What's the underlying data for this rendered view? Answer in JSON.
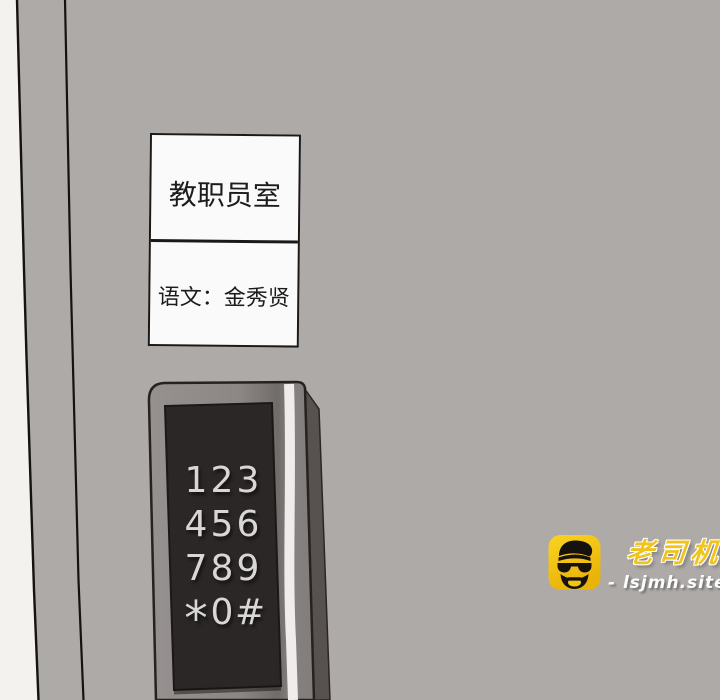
{
  "sign": {
    "room_label": "教职员室",
    "teacher_label": "语文：金秀贤"
  },
  "keypad": {
    "rows": [
      [
        "1",
        "2",
        "3"
      ],
      [
        "4",
        "5",
        "6"
      ],
      [
        "7",
        "8",
        "9"
      ],
      [
        "*",
        "0",
        "#"
      ]
    ]
  },
  "watermark": {
    "brand": "老司机",
    "site": "- lsjmh.site -"
  },
  "colors": {
    "door": "#aeaaa8",
    "wall_strip": "#f4f2ef",
    "line_ink": "#131313",
    "sign_background": "#fbfafa",
    "keypad_bezel": "#8b8683",
    "keypad_panel": "#2b2726",
    "keypad_side_shadow": "#575250",
    "keypad_highlight_stripe": "#efeceb",
    "keypad_digits": "#d9d7d6",
    "brand_yellow": "#f1c41c",
    "icon_yellow": "#f6c70e"
  }
}
